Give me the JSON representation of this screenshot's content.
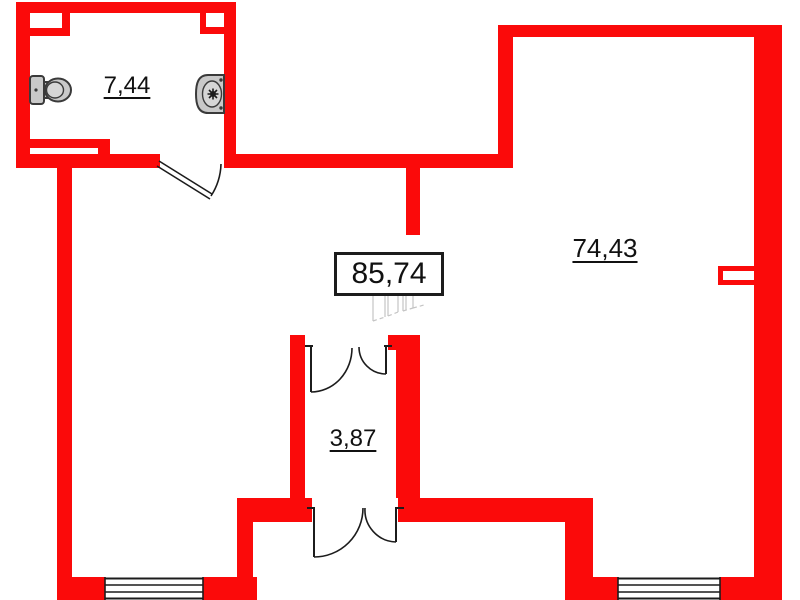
{
  "floor_plan": {
    "rooms": [
      {
        "name": "bathroom",
        "area": "7,44"
      },
      {
        "name": "main-room",
        "area": "74,43"
      },
      {
        "name": "hallway",
        "area": "3,87"
      },
      {
        "name": "total-area",
        "area": "85,74"
      }
    ],
    "fixtures": [
      {
        "name": "toilet"
      },
      {
        "name": "sink"
      }
    ],
    "colors": {
      "wall": "#fb0a0a",
      "line": "#1c1c1c",
      "fixture_fill": "#c9c9c9",
      "fixture_inner": "#d6d6d6",
      "outline": "#3a3a3a"
    }
  }
}
